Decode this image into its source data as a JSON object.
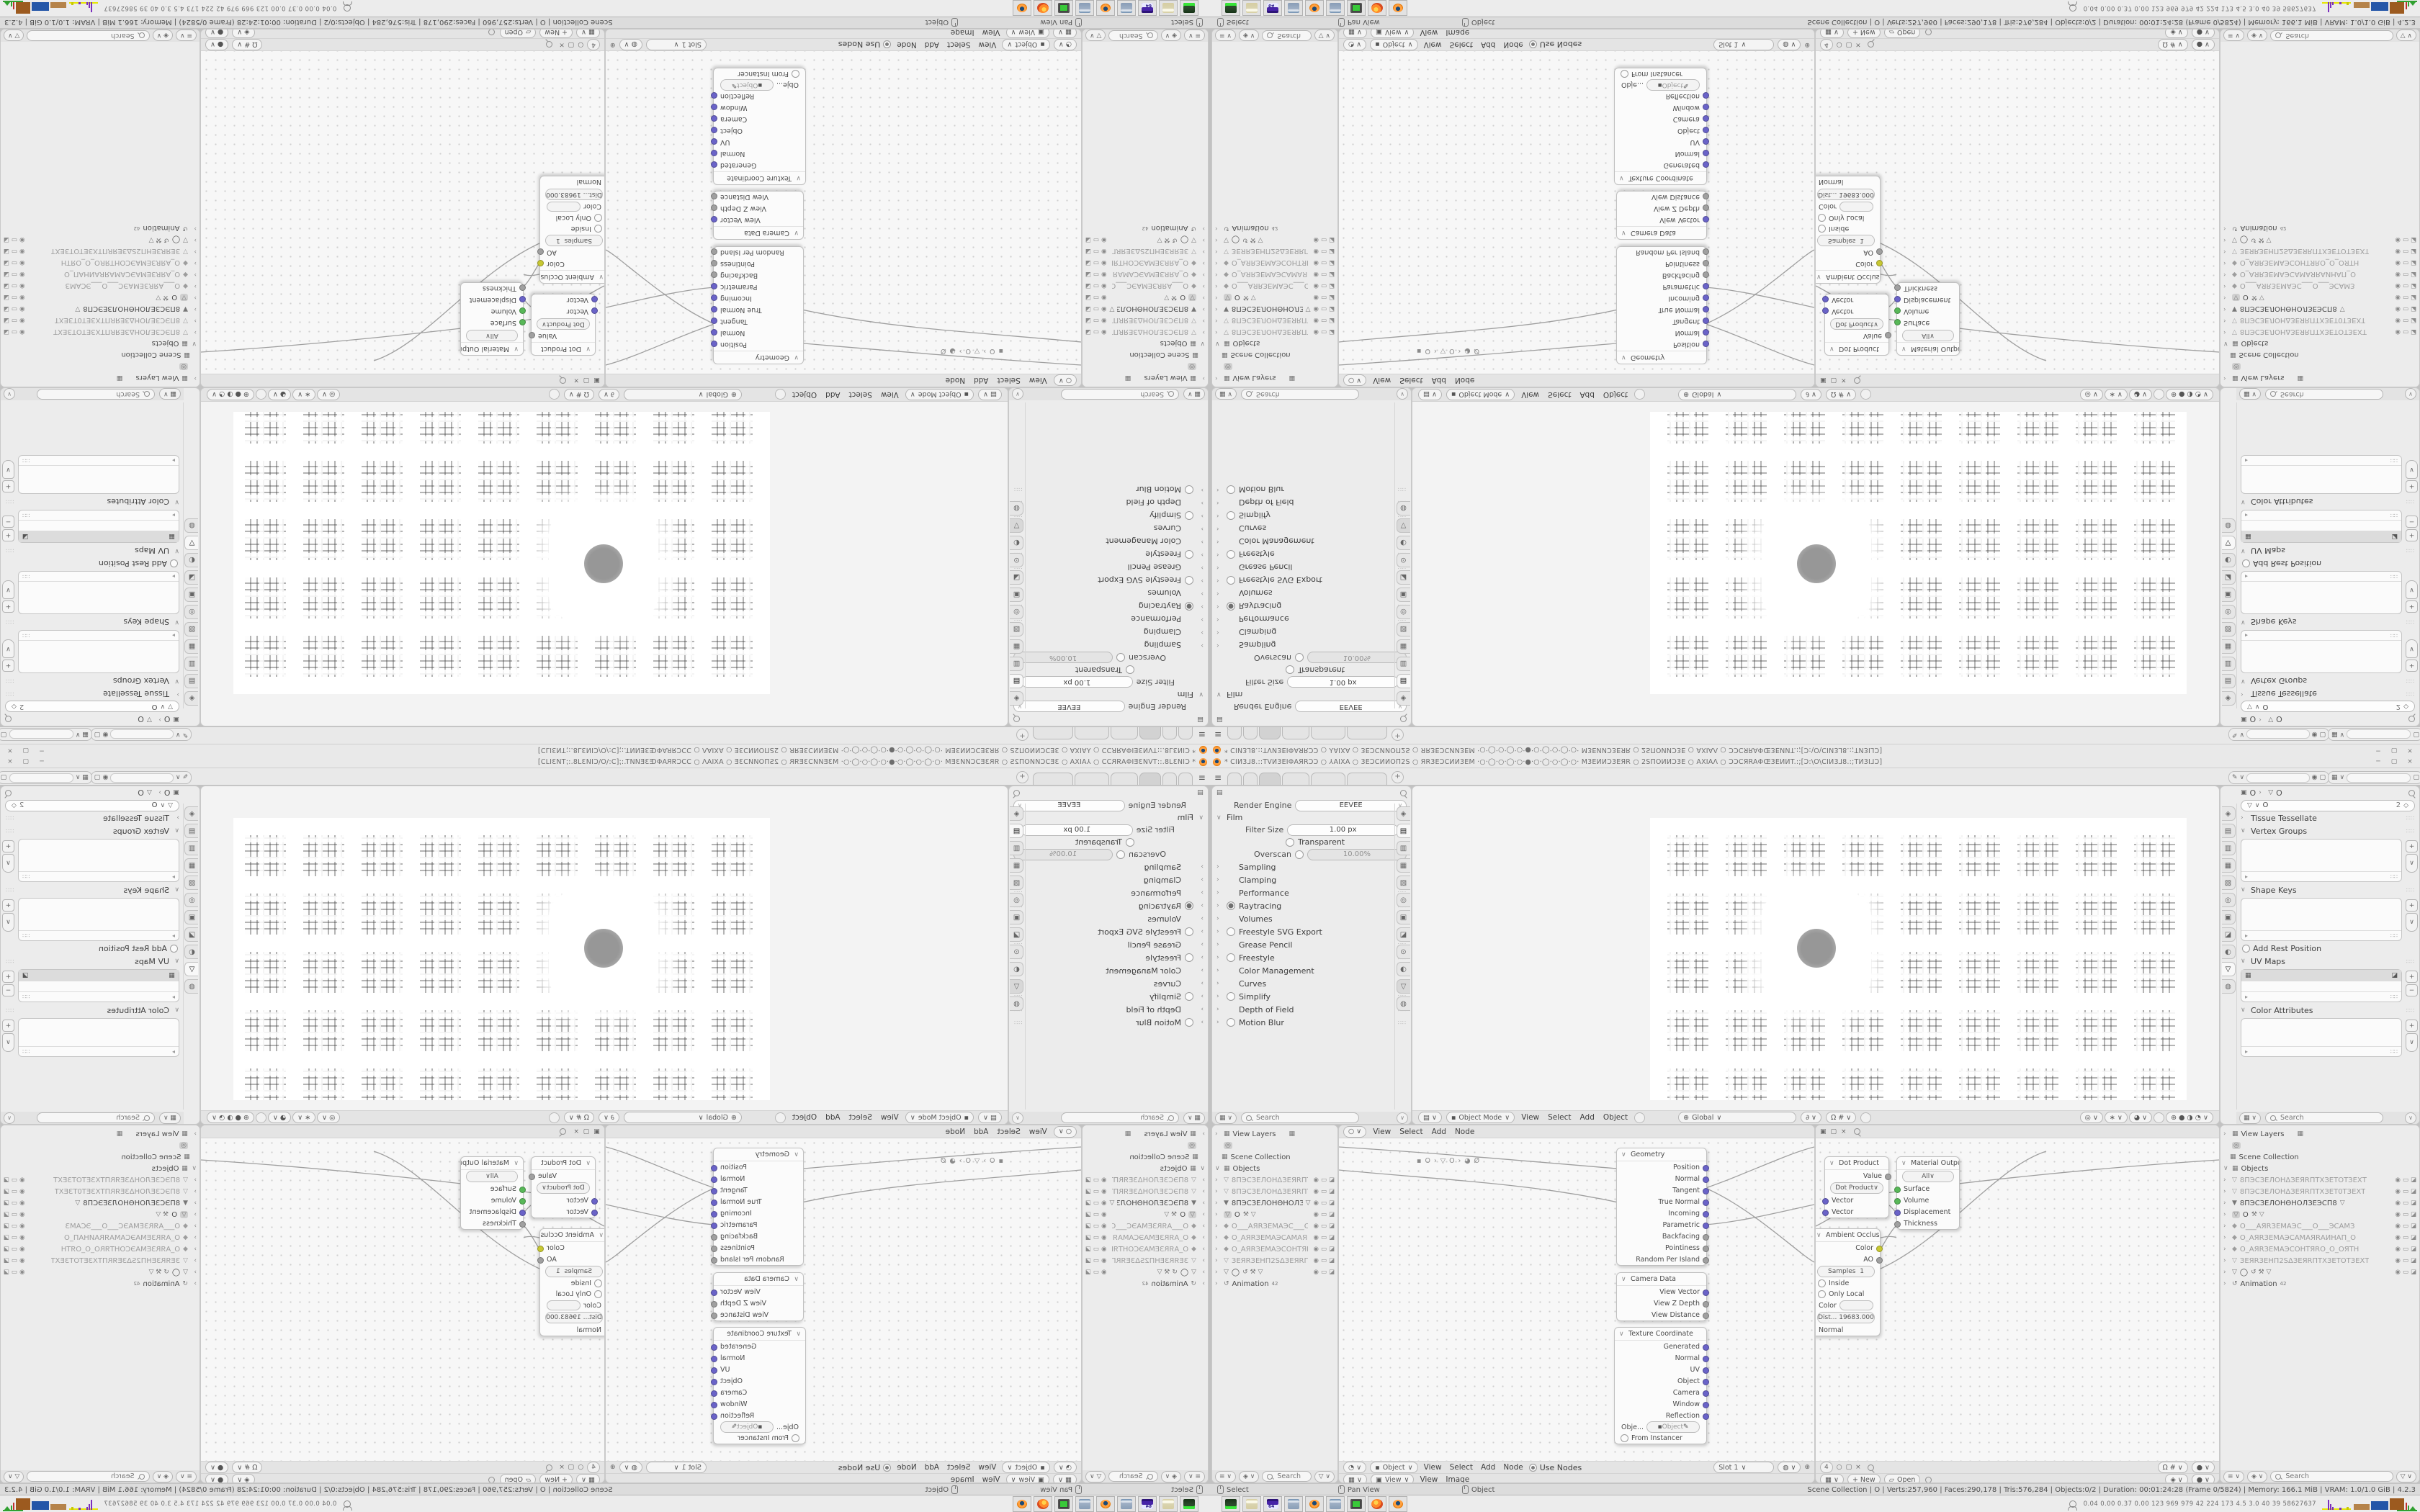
{
  "titlebar": {
    "title": "* CIИ3⅃8.::TVИ3EIΦAЯRƆƆ ○ ⅄AIXA ○ 3EƆCИИOΠ2S ○ ЯR3EƆCИИ3EM ·○·◯·○·◯·○·●·○·◯·○·◯·○· M3EИИƆ3EЯR ○ 2SΠOИИƆ3E ○ AXIAΛ ○ ƆƆCЯRAΦŒ3EИИT.:;[Ɔ:\\O\\CIИ3⅃8.:;TИ3I⅃Ɔ]",
    "min": "─",
    "max": "▢",
    "close": "×"
  },
  "topbar": {
    "add_tab": "+"
  },
  "render_props": {
    "engine_label": "Render Engine",
    "engine_value": "EEVEE",
    "film": {
      "label": "Film",
      "filter_size_label": "Filter Size",
      "filter_size_value": "1.00 px",
      "transparent_label": "Transparent",
      "overscan_label": "Overscan",
      "overscan_value": "10.00%"
    },
    "sections": [
      {
        "l": "Sampling"
      },
      {
        "l": "Clamping"
      },
      {
        "l": "Performance"
      },
      {
        "l": "Raytracing",
        "t": "on"
      },
      {
        "l": "Volumes"
      },
      {
        "l": "Freestyle SVG Export",
        "t": "off"
      },
      {
        "l": "Grease Pencil"
      },
      {
        "l": "Freestyle",
        "t": "off"
      },
      {
        "l": "Color Management"
      },
      {
        "l": "Curves"
      },
      {
        "l": "Simplify",
        "t": "off"
      },
      {
        "l": "Depth of Field"
      },
      {
        "l": "Motion Blur",
        "t": "off"
      }
    ],
    "search_placeholder": "Search"
  },
  "viewport": {
    "mode": "Object Mode",
    "menu_view": "View",
    "menu_select": "Select",
    "menu_add": "Add",
    "menu_object": "Object",
    "orientation": "Global"
  },
  "data_props": {
    "breadcrumb_object": "O",
    "breadcrumb_data": "O",
    "name_field": "O",
    "users": "2",
    "panels": {
      "tissue": "Tissue Tessellate",
      "vgroups": "Vertex Groups",
      "shapekeys": "Shape Keys",
      "rest": "Add Rest Position",
      "uvmaps": "UV Maps",
      "colorattrs": "Color Attributes"
    },
    "search_placeholder": "Search"
  },
  "outliner": {
    "view_layers": "View Layers",
    "scene_collection": "Scene Collection",
    "objects": "Objects",
    "animation": "Animation",
    "anim_badge": "42",
    "items": [
      {
        "ic": "▽",
        "nm": "8ПЭСЗЕЛОНΔЗЕЯRПТХЗЕТОТЗЕХТ",
        "dm": 1,
        "mid": ""
      },
      {
        "ic": "▽",
        "nm": "8ПЭСЗЕЛОНΔЗЕЯRПТХЗЕТ0ТЗЕХТ",
        "dm": 1,
        "mid": ""
      },
      {
        "ic": "▼",
        "nm": "8ПЭСЗЕЛОНΘНОЛЗЕЭСП8",
        "dm": 0,
        "mid": "▽"
      },
      {
        "ic": "▽",
        "nm": "O",
        "dm": 0,
        "mid": "⚒ ▽",
        "sel": "selbox"
      },
      {
        "ic": "◆",
        "nm": "O___AЯRЗЕМАЭС___O___ЭСАМЗ",
        "dm": 1,
        "mid": ""
      },
      {
        "ic": "◆",
        "nm": "O_АЯRЗЕМАЭСАМАЯRАИНАП_О",
        "dm": 1,
        "mid": ""
      },
      {
        "ic": "◆",
        "nm": "O_АЯRЗЕМАЭСОНТЯRО_О_ОЯТН",
        "dm": 1,
        "mid": ""
      },
      {
        "ic": "▽",
        "nm": "ЗЕЯRЗЕНП2SΔЗЕЯRПТХЗЕТОТЗЕХТ",
        "dm": 1,
        "mid": ""
      },
      {
        "ic": "▽",
        "nm": "◯",
        "dm": 0,
        "mid": "↺ ⚒ ▽"
      }
    ],
    "search_placeholder": "Search"
  },
  "shader": {
    "object_pill": "Object",
    "menu_view": "View",
    "menu_select": "Select",
    "menu_add": "Add",
    "menu_node": "Node",
    "use_nodes": "Use Nodes",
    "slot": "Slot 1",
    "badge": "4",
    "path_object": "O",
    "path_data": "O",
    "path_material": "Ø"
  },
  "image_editor": {
    "view_pill": "View",
    "menu_view": "View",
    "menu_image": "Image",
    "new_btn": "+ New",
    "open_btn": "Open"
  },
  "nodes": {
    "geometry": {
      "title": "Geometry",
      "outputs": [
        {
          "l": "Position",
          "c": "v"
        },
        {
          "l": "Normal",
          "c": "v"
        },
        {
          "l": "Tangent",
          "c": "v"
        },
        {
          "l": "True Normal",
          "c": "v"
        },
        {
          "l": "Incoming",
          "c": "v"
        },
        {
          "l": "Parametric",
          "c": "v"
        },
        {
          "l": "Backfacing",
          "c": "f"
        },
        {
          "l": "Pointiness",
          "c": "f"
        },
        {
          "l": "Random Per Island",
          "c": "f"
        }
      ]
    },
    "camera_data": {
      "title": "Camera Data",
      "outputs": [
        {
          "l": "View Vector",
          "c": "v"
        },
        {
          "l": "View Z Depth",
          "c": "f"
        },
        {
          "l": "View Distance",
          "c": "f"
        }
      ]
    },
    "tex_coord": {
      "title": "Texture Coordinate",
      "outputs": [
        {
          "l": "Generated",
          "c": "v"
        },
        {
          "l": "Normal",
          "c": "v"
        },
        {
          "l": "UV",
          "c": "v"
        },
        {
          "l": "Object",
          "c": "v"
        },
        {
          "l": "Camera",
          "c": "v"
        },
        {
          "l": "Window",
          "c": "v"
        },
        {
          "l": "Reflection",
          "c": "v"
        }
      ],
      "object_label": "Obje...",
      "object_value": "Object",
      "from_instancer": "From Instancer"
    },
    "dot_product": {
      "title": "Dot Product",
      "value_out": "Value",
      "operation": "Dot Product",
      "inputs": [
        {
          "l": "Vector",
          "c": "v"
        },
        {
          "l": "Vector",
          "c": "v"
        }
      ]
    },
    "material_output": {
      "title": "Material Output",
      "target": "All",
      "inputs": [
        {
          "l": "Surface",
          "c": "g"
        },
        {
          "l": "Volume",
          "c": "g"
        },
        {
          "l": "Displacement",
          "c": "v"
        },
        {
          "l": "Thickness",
          "c": "f"
        }
      ]
    },
    "ao": {
      "title": "Ambient Occlusion",
      "out_color": "Color",
      "out_ao": "AO",
      "samples_label": "Samples",
      "samples_value": "1",
      "inside": "Inside",
      "only_local": "Only Local",
      "color_in": "Color",
      "dist_label": "Dist...",
      "dist_value": "19683.000",
      "normal_in": "Normal"
    }
  },
  "status": {
    "hint_select": "Select",
    "hint_pan": "Pan View",
    "hint_object": "Object",
    "stats": "Scene Collection | O | Verts:257,960 | Faces:290,178 | Tris:576,284 | Objects:0/2 | Duration: 00:01:24:28 (Frame 0/5824) | Memory: 166.1 MiB | VRAM: 1.0/1.0 GiB | 4.2.3"
  },
  "taskbar": {
    "apps": [
      {
        "k": "drive"
      },
      {
        "k": "notepad"
      },
      {
        "k": "floppy"
      },
      {
        "k": "calc"
      },
      {
        "k": "blender"
      },
      {
        "k": "calc"
      },
      {
        "k": "monitor"
      },
      {
        "k": "firefox"
      },
      {
        "k": "blender"
      }
    ],
    "stats": "0.04 0.00 0.37 0.00  123  969  979  42  224  173  4.5  3.0  40  39  58627637"
  },
  "colors": {
    "blender_orange": "#e87d0d",
    "socket_vector": "#6a63c8",
    "socket_float": "#a0a0a0",
    "socket_shader": "#58b858",
    "socket_color": "#c8c832",
    "ui_panel": "#ececec",
    "ui_canvas": "#f7f7f7"
  }
}
